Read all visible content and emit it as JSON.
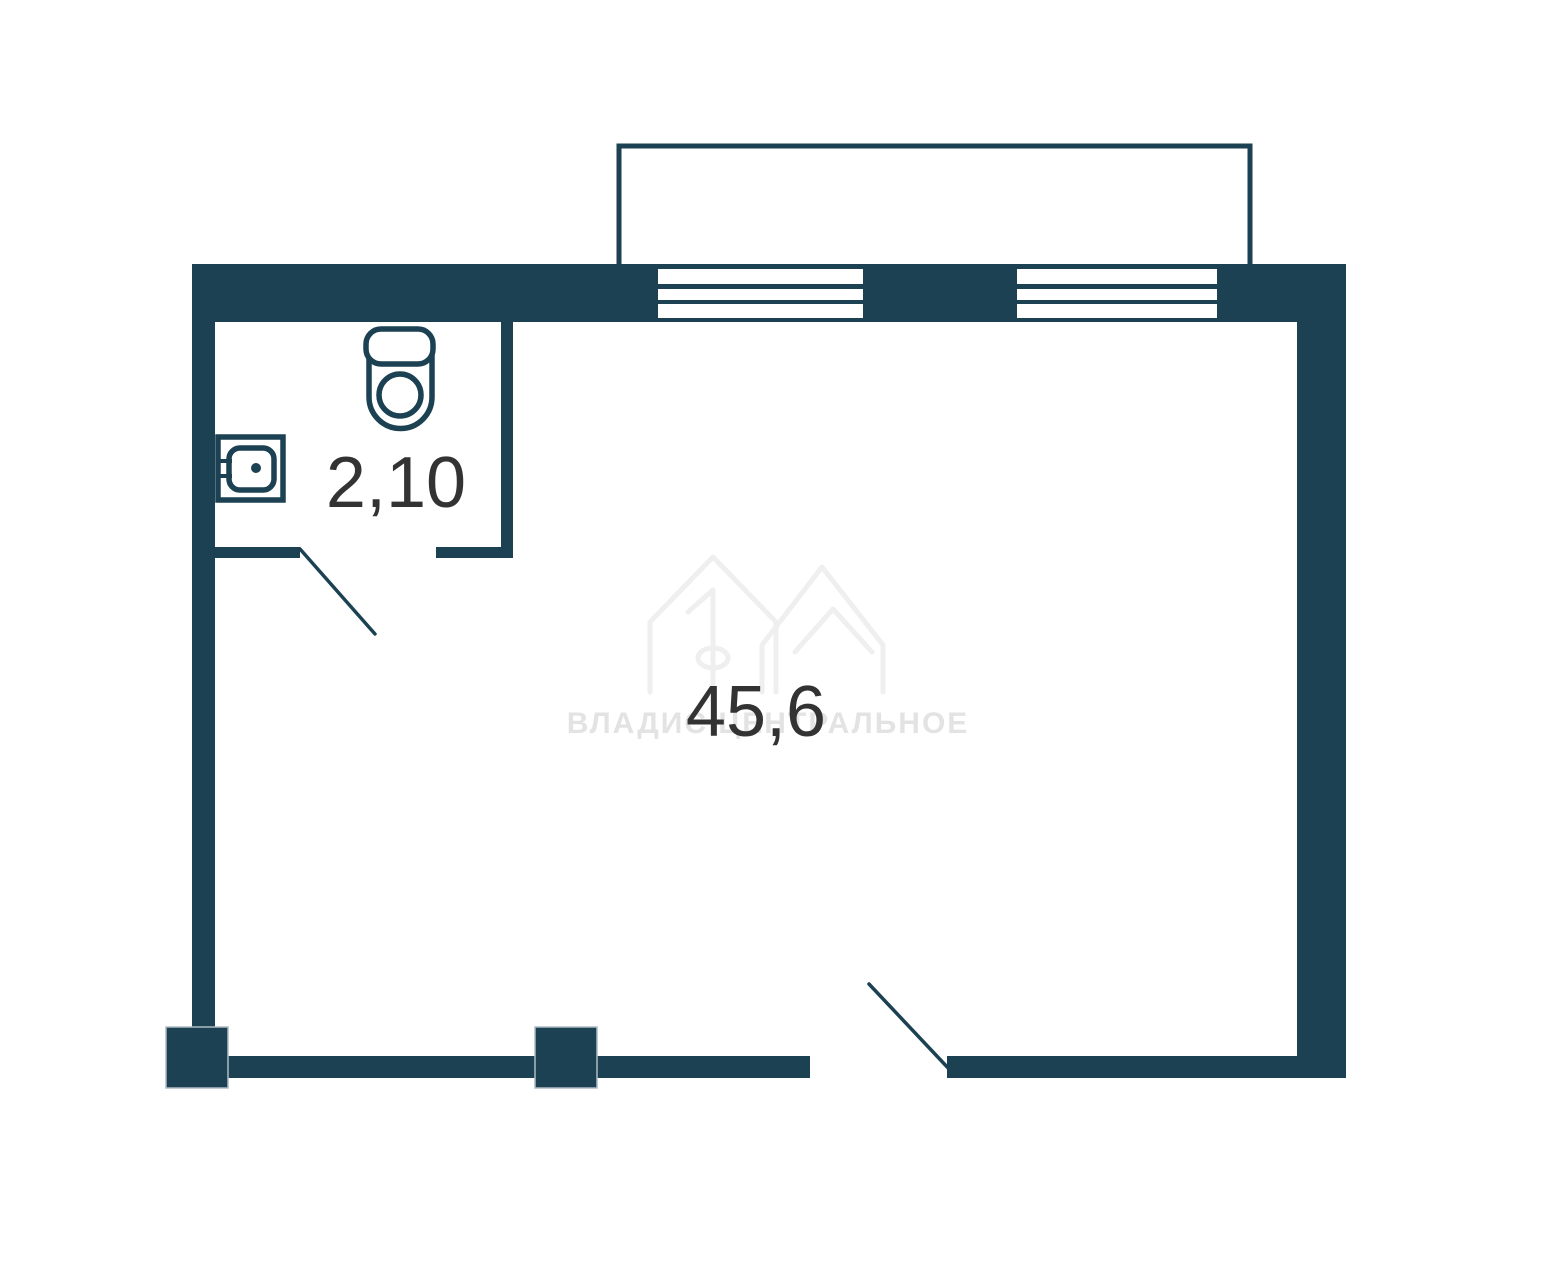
{
  "plan": {
    "type": "apartment-floor-plan",
    "rooms": {
      "bathroom": {
        "name": "bathroom",
        "area_label": "2,10",
        "fixtures": [
          "toilet-icon",
          "sink-icon"
        ]
      },
      "living": {
        "name": "living-room",
        "area_label": "45,6"
      }
    },
    "features": [
      "balcony",
      "window-1",
      "window-2",
      "bathroom-door-swing",
      "entry-door-swing",
      "column-left",
      "column-middle"
    ]
  },
  "watermark": {
    "logo": "house-10-logo",
    "logo_digit": "1",
    "text": "ВЛАДИС ЦЕНТРАЛЬНОЕ"
  },
  "colors": {
    "wall": "#1b4152",
    "label": "#333333",
    "watermark": "#efefef",
    "watermark_text": "#e3e3e3",
    "column_border": "#aebcc2",
    "background": "#ffffff"
  }
}
